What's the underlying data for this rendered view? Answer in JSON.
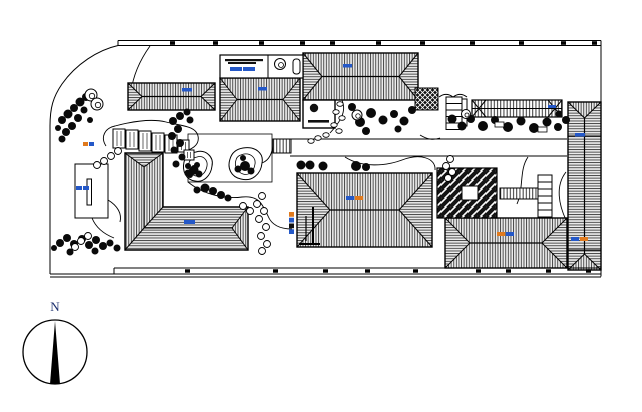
{
  "page": {
    "background": "#ffffff",
    "title": "residential landscape site plan"
  },
  "compass": {
    "label": "N",
    "label_color": "#1b2f6e"
  },
  "colors": {
    "ink": "#000000",
    "roof_fill": "#ececec",
    "label_blue": "#2458c8",
    "label_orange": "#e07a1e",
    "dark_fill": "#0a0a0a"
  },
  "drawing": {
    "plaza": {
      "x": 188,
      "y": 134,
      "w": 84,
      "h": 48
    },
    "road": {
      "x1": 290,
      "x2": 567,
      "yt": 139,
      "yb": 156
    },
    "garden_paths": [
      "M106,146 C100,137 105,128 115,126 C130,122 150,118 166,122 C182,126 196,126 198,136 C200,145 191,151 181,151",
      "M188,182 C205,196 228,199 242,197 C260,195 263,206 268,216 C272,226 282,229 292,229",
      "M345,157 C362,168 386,166 402,160 C420,153 436,158 435,170",
      "M528,157 C519,170 524,188 517,204",
      "M566,172 C555,186 559,205 566,220",
      "M342,100 C347,112 340,122 330,133",
      "M150,46 C140,60 133,76 131,92",
      "M108,200 C118,206 122,214 120,222",
      "M262,163 C270,160 272,152 273,146",
      "M92,218 C96,228 104,234 114,238",
      "M420,135 C428,140 434,140 440,138"
    ],
    "ponds": [
      {
        "outer": "M196,152 C206,149 214,157 212,166 C211,175 204,183 195,181 C186,180 182,171 184,162 C186,155 190,153 196,152 Z",
        "inner": "M197,157 C203,155 208,160 207,166 C206,172 202,177 196,176 C190,175 188,169 189,163 C190,159 193,158 197,157 Z",
        "rocks": [
          [
            194,
            170,
            4.5
          ],
          [
            199,
            174,
            3.5
          ],
          [
            190,
            175,
            3
          ],
          [
            197,
            165,
            3
          ]
        ]
      },
      {
        "outer": "M243,148 C255,146 264,153 262,163 C261,174 252,182 241,179 C231,177 227,168 230,159 C232,152 237,149 243,148 Z",
        "inner": "M244,154 C251,153 256,158 255,164 C254,171 249,176 243,174 C237,172 234,166 236,160 C237,156 240,155 244,154 Z",
        "rocks": [
          [
            245,
            166,
            5
          ],
          [
            238,
            169,
            3.5
          ],
          [
            251,
            171,
            3.5
          ],
          [
            243,
            158,
            3
          ]
        ]
      }
    ],
    "hip_buildings": [
      {
        "id": "roof-a",
        "x": 128,
        "y": 83,
        "w": 87,
        "h": 27,
        "o": "h",
        "ins": 14
      },
      {
        "id": "roof-b",
        "x": 220,
        "y": 78,
        "w": 80,
        "h": 43,
        "o": "h",
        "ins": 17
      },
      {
        "id": "roof-c",
        "x": 303,
        "y": 53,
        "w": 115,
        "h": 47,
        "o": "h",
        "ins": 19
      },
      {
        "id": "roof-n",
        "x": 297,
        "y": 173,
        "w": 135,
        "h": 74,
        "o": "h",
        "ins": 33
      },
      {
        "id": "roof-p",
        "x": 445,
        "y": 218,
        "w": 122,
        "h": 50,
        "o": "h",
        "ins": 25
      },
      {
        "id": "roof-h",
        "x": 568,
        "y": 102,
        "w": 33,
        "h": 168,
        "o": "v",
        "ins": 16,
        "div": [
          136,
          250
        ]
      }
    ],
    "l_building": {
      "outline": "M125,153 L163,153 L163,207 L248,207 L248,250 L125,250 Z",
      "vpoly": "125,153 163,153 163,207 144,228 125,250",
      "hpoly": "163,207 248,207 248,250 125,250 144,228",
      "tri_top": "125,153 163,153 144,167",
      "tri_right": "248,207 248,250 232,228",
      "lines": [
        [
          125,
          153,
          144,
          167
        ],
        [
          163,
          153,
          144,
          167
        ],
        [
          144,
          167,
          144,
          228
        ],
        [
          163,
          207,
          144,
          228
        ],
        [
          125,
          250,
          144,
          228
        ],
        [
          144,
          228,
          232,
          228
        ],
        [
          248,
          207,
          232,
          228
        ],
        [
          248,
          250,
          232,
          228
        ]
      ]
    },
    "herringbone_court": {
      "x": 437,
      "y": 168,
      "w": 60,
      "h": 50,
      "square": [
        462,
        186,
        16,
        14
      ]
    },
    "crosshatch_square": {
      "x": 415,
      "y": 88,
      "w": 23,
      "h": 22
    },
    "top_room": {
      "x": 220,
      "y": 55,
      "w": 83,
      "h": 23,
      "divider_x": 268,
      "bars": [
        [
          225,
          59,
          38,
          2.2
        ],
        [
          228,
          62,
          28,
          2
        ]
      ],
      "pill": [
        293,
        59,
        7,
        15
      ]
    },
    "pavilion": {
      "x": 303,
      "y": 100,
      "w": 32,
      "h": 28,
      "circle": [
        314,
        108,
        4.2
      ],
      "bar": [
        308,
        120,
        21,
        2.6
      ]
    },
    "small_building": {
      "x": 75,
      "y": 164,
      "w": 33,
      "h": 54,
      "slot": [
        87,
        179,
        4.5,
        26
      ]
    },
    "pergola_long": {
      "x": 472,
      "y": 100,
      "w": 90,
      "h": 17
    },
    "pergola_beams": [
      [
        113,
        129,
        12,
        19
      ],
      [
        126,
        130,
        12,
        19
      ],
      [
        139,
        131,
        12,
        20
      ],
      [
        152,
        133,
        12,
        19
      ],
      [
        165,
        135,
        12,
        18
      ],
      [
        178,
        140,
        11,
        12
      ],
      [
        184,
        150,
        10,
        10
      ]
    ],
    "walkway_striped": {
      "x": 500,
      "y": 188,
      "w": 40,
      "h": 11
    },
    "bridge": {
      "x": 273,
      "y": 139,
      "w": 18,
      "h": 14
    },
    "door_arcs": [
      "M439,97 A14,20 0 0 1 453,97",
      "M453,97 A14,20 0 0 1 467,97"
    ],
    "stairs": [
      {
        "x": 446,
        "y": 97,
        "sw": 16,
        "sh": 6.5,
        "n": 5,
        "rail": [
          462,
          99,
          5,
          27
        ]
      },
      {
        "x": 538,
        "y": 175,
        "sw": 14,
        "sh": 7,
        "n": 6
      }
    ],
    "trees_dark": [
      [
        62,
        120,
        4
      ],
      [
        68,
        114,
        4.5
      ],
      [
        74,
        108,
        4
      ],
      [
        80,
        102,
        4.5
      ],
      [
        86,
        97,
        4
      ],
      [
        78,
        118,
        4
      ],
      [
        72,
        126,
        4
      ],
      [
        66,
        132,
        4
      ],
      [
        62,
        139,
        3.5
      ],
      [
        84,
        110,
        3.5
      ],
      [
        90,
        120,
        3
      ],
      [
        58,
        128,
        3
      ],
      [
        173,
        121,
        4
      ],
      [
        180,
        116,
        4
      ],
      [
        187,
        112,
        3.5
      ],
      [
        178,
        129,
        4
      ],
      [
        172,
        136,
        4
      ],
      [
        180,
        143,
        4
      ],
      [
        174,
        150,
        3.5
      ],
      [
        182,
        157,
        3.5
      ],
      [
        176,
        164,
        3.5
      ],
      [
        190,
        120,
        3.5
      ],
      [
        188,
        166,
        3
      ],
      [
        193,
        172,
        3
      ],
      [
        205,
        188,
        4.5
      ],
      [
        213,
        191,
        4
      ],
      [
        221,
        195,
        4
      ],
      [
        197,
        190,
        3.5
      ],
      [
        228,
        198,
        3.5
      ],
      [
        60,
        243,
        4
      ],
      [
        67,
        238,
        4
      ],
      [
        74,
        244,
        4
      ],
      [
        82,
        239,
        4
      ],
      [
        89,
        245,
        4
      ],
      [
        96,
        240,
        4
      ],
      [
        103,
        246,
        4
      ],
      [
        95,
        251,
        3.5
      ],
      [
        70,
        252,
        3.5
      ],
      [
        110,
        243,
        3.5
      ],
      [
        117,
        248,
        3.5
      ],
      [
        54,
        248,
        3
      ],
      [
        301,
        165,
        4.5
      ],
      [
        310,
        165,
        4.5
      ],
      [
        323,
        166,
        4.5
      ],
      [
        356,
        166,
        5
      ],
      [
        366,
        167,
        4
      ],
      [
        352,
        107,
        4
      ],
      [
        360,
        122,
        5
      ],
      [
        371,
        113,
        5
      ],
      [
        383,
        120,
        4.5
      ],
      [
        394,
        114,
        4
      ],
      [
        404,
        121,
        4.5
      ],
      [
        412,
        110,
        4
      ],
      [
        366,
        131,
        4
      ],
      [
        398,
        129,
        3.5
      ],
      [
        483,
        126,
        5
      ],
      [
        495,
        120,
        4
      ],
      [
        508,
        127,
        5
      ],
      [
        521,
        121,
        4.5
      ],
      [
        534,
        128,
        5
      ],
      [
        547,
        122,
        4.5
      ],
      [
        558,
        127,
        4
      ],
      [
        566,
        120,
        4
      ],
      [
        559,
        114,
        3.5
      ],
      [
        452,
        119,
        4.5
      ],
      [
        462,
        126,
        4.5
      ],
      [
        471,
        119,
        4
      ],
      [
        188,
        173,
        3.5
      ],
      [
        194,
        168,
        3
      ]
    ],
    "trees_light": [
      [
        91,
        95,
        6
      ],
      [
        97,
        104,
        6
      ],
      [
        280,
        64,
        5.5
      ],
      [
        357,
        115,
        5
      ],
      [
        466,
        114,
        4.5
      ]
    ],
    "shrub_chains": [
      [
        [
          118,
          151
        ],
        [
          111,
          156
        ],
        [
          104,
          161
        ],
        [
          97,
          165
        ]
      ],
      [
        [
          262,
          196
        ],
        [
          257,
          204
        ],
        [
          264,
          211
        ],
        [
          259,
          219
        ],
        [
          266,
          227
        ],
        [
          261,
          236
        ],
        [
          267,
          244
        ],
        [
          262,
          251
        ]
      ],
      [
        [
          450,
          159
        ],
        [
          446,
          166
        ],
        [
          452,
          172
        ],
        [
          448,
          178
        ]
      ],
      [
        [
          243,
          206
        ],
        [
          250,
          211
        ]
      ],
      [
        [
          88,
          236
        ],
        [
          81,
          241
        ],
        [
          75,
          247
        ]
      ]
    ],
    "stepping_stones": [
      [
        340,
        104
      ],
      [
        336,
        112
      ],
      [
        342,
        118
      ],
      [
        334,
        125
      ],
      [
        339,
        131
      ],
      [
        326,
        135
      ],
      [
        318,
        138
      ],
      [
        311,
        141
      ]
    ],
    "white_stones": [
      [
        495,
        122,
        9,
        5
      ],
      [
        538,
        127,
        9,
        5
      ]
    ],
    "markers": [
      [
        313,
        207,
        313,
        243,
        2
      ],
      [
        306,
        216,
        306,
        241,
        1.2
      ],
      [
        299,
        244,
        320,
        244,
        2
      ]
    ],
    "tiny_labels": [
      {
        "x": 182,
        "y": 88,
        "w": 10,
        "h": 3.5,
        "c": [
          "#2458c8"
        ]
      },
      {
        "x": 258,
        "y": 87,
        "w": 9,
        "h": 3.5,
        "c": [
          "#2458c8"
        ]
      },
      {
        "x": 343,
        "y": 64,
        "w": 9,
        "h": 3.5,
        "c": [
          "#2458c8"
        ]
      },
      {
        "x": 230,
        "y": 67,
        "w": 25,
        "h": 4,
        "c": [
          "#2458c8",
          "#2458c8"
        ]
      },
      {
        "x": 83,
        "y": 142,
        "w": 11,
        "h": 4,
        "c": [
          "#e07a1e",
          "#2458c8"
        ]
      },
      {
        "x": 76,
        "y": 186,
        "w": 13,
        "h": 4,
        "c": [
          "#2458c8",
          "#2458c8"
        ]
      },
      {
        "x": 184,
        "y": 220,
        "w": 11,
        "h": 4,
        "c": [
          "#2458c8"
        ]
      },
      {
        "x": 346,
        "y": 196,
        "w": 17,
        "h": 4,
        "c": [
          "#2458c8",
          "#e07a1e"
        ]
      },
      {
        "x": 497,
        "y": 232,
        "w": 17,
        "h": 4,
        "c": [
          "#e07a1e",
          "#2458c8"
        ]
      },
      {
        "x": 575,
        "y": 133,
        "w": 10,
        "h": 3.5,
        "c": [
          "#2458c8"
        ]
      },
      {
        "x": 571,
        "y": 237,
        "w": 17,
        "h": 4,
        "c": [
          "#2458c8",
          "#e07a1e"
        ]
      },
      {
        "x": 548,
        "y": 105,
        "w": 8,
        "h": 3,
        "c": [
          "#2458c8"
        ]
      }
    ],
    "vertical_label": {
      "x": 289,
      "y": 212,
      "w": 5,
      "h": 22,
      "c": [
        "#e07a1e",
        "#2458c8",
        "#111111",
        "#2458c8"
      ]
    },
    "boundary": {
      "top_lines": [
        [
          118,
          40.5,
          601,
          40.5
        ],
        [
          118,
          45.5,
          601,
          45.5
        ],
        [
          118,
          40.5,
          118,
          45.5
        ]
      ],
      "right_line": [
        601,
        40.5,
        601,
        276.5
      ],
      "bottom_lines": [
        [
          114,
          268,
          601,
          268
        ],
        [
          114,
          268,
          114,
          274
        ],
        [
          50,
          274,
          601,
          274
        ],
        [
          50,
          277,
          601,
          277
        ]
      ],
      "left_curve": "M118,45.5 C98,50 76,64 62,84 C53,97 50,108 50,126 L50,274",
      "ticks_top": [
        170,
        213,
        259,
        300,
        330,
        376,
        420,
        470,
        519,
        561,
        592
      ],
      "ticks_bottom": [
        185,
        273,
        323,
        365,
        413,
        476,
        506,
        546,
        586
      ]
    },
    "compass_geo": {
      "cx": 55,
      "cy": 352,
      "r": 32,
      "apex_y": 321,
      "base_y": 384,
      "base_half": 5
    }
  }
}
